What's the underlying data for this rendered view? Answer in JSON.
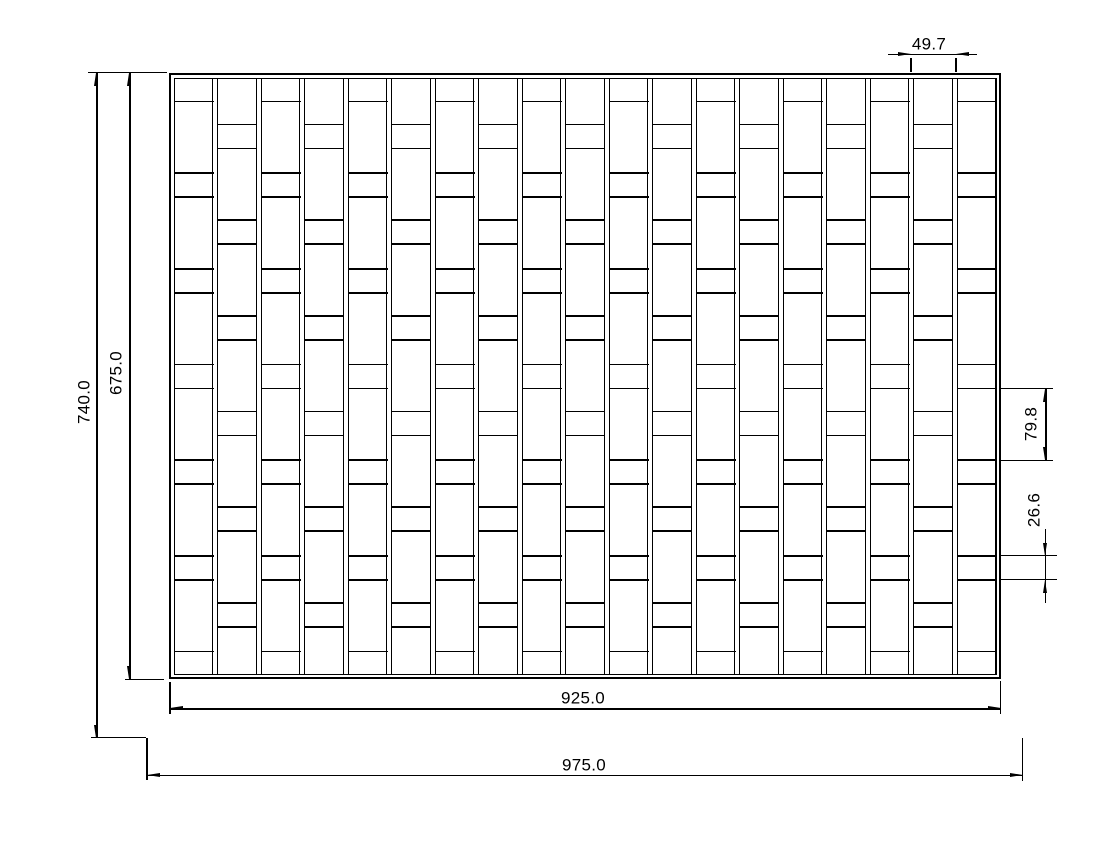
{
  "drawing": {
    "type": "technical-dimension-drawing",
    "background": "#ffffff",
    "line_color": "#000000",
    "panel": {
      "outer": {
        "x": 169,
        "y": 73,
        "w": 832,
        "h": 606
      },
      "border_gap": 4.5,
      "num_slats": 19,
      "slat_width": 40,
      "slat_pitch": 43.5,
      "short_segment": 24,
      "tall_segment": 71.67,
      "odd_column_first_segment": 47
    },
    "dimension_values": {
      "overall_height": "740.0",
      "panel_height": "675.0",
      "panel_width": "925.0",
      "overall_width": "975.0",
      "slat_pitch": "49.7",
      "tall_block_height": "79.8",
      "short_block_height": "26.6"
    },
    "dims": [
      {
        "id": "overall-height",
        "text": "740.0",
        "line": [
          97,
          73,
          97,
          738
        ],
        "arrows": [
          {
            "x": 97,
            "y": 73,
            "dir": "up"
          },
          {
            "x": 97,
            "y": 738,
            "dir": "down"
          }
        ],
        "ext": [
          [
            88,
            72.7,
            167,
            72.7
          ],
          [
            91,
            737.6,
            146,
            737.6
          ]
        ],
        "label": {
          "cx": 84,
          "cy": 402,
          "rot": -90
        }
      },
      {
        "id": "panel-height",
        "text": "675.0",
        "line": [
          130,
          73,
          130,
          679.4
        ],
        "arrows": [
          {
            "x": 130,
            "y": 73,
            "dir": "up"
          },
          {
            "x": 130,
            "y": 679.2,
            "dir": "down"
          }
        ],
        "ext": [
          [
            125,
            679.8,
            164,
            679.8
          ]
        ],
        "label": {
          "cx": 116,
          "cy": 373,
          "rot": -90
        }
      },
      {
        "id": "panel-width",
        "text": "925.0",
        "line": [
          170,
          709,
          1001,
          709
        ],
        "arrows": [
          {
            "x": 170.3,
            "y": 709,
            "dir": "left"
          },
          {
            "x": 1000.7,
            "y": 709,
            "dir": "right"
          }
        ],
        "ext": [
          [
            170,
            682,
            170,
            714
          ],
          [
            1000.7,
            681,
            1000.7,
            713.6
          ]
        ],
        "label": {
          "cx": 583,
          "cy": 698,
          "rot": 0
        }
      },
      {
        "id": "overall-width",
        "text": "975.0",
        "line": [
          147,
          775.5,
          1023,
          775.5
        ],
        "arrows": [
          {
            "x": 147.3,
            "y": 775.5,
            "dir": "left"
          },
          {
            "x": 1022.7,
            "y": 775.5,
            "dir": "right"
          }
        ],
        "ext": [
          [
            147,
            737.6,
            147,
            780.5
          ],
          [
            1022.7,
            738,
            1022.7,
            780.5
          ]
        ],
        "label": {
          "cx": 584,
          "cy": 764.5,
          "rot": 0
        }
      },
      {
        "id": "slat-pitch",
        "text": "49.7",
        "line": [
          888,
          54.3,
          977,
          54.3
        ],
        "arrows": [
          {
            "x": 911,
            "y": 54.3,
            "dir": "right"
          },
          {
            "x": 956,
            "y": 54.3,
            "dir": "left"
          }
        ],
        "ext": [
          [
            911,
            58,
            911,
            71.5
          ],
          [
            956,
            58,
            956,
            71.5
          ]
        ],
        "label": {
          "cx": 929,
          "cy": 44,
          "rot": 0
        }
      },
      {
        "id": "tall-block-height",
        "text": "79.8",
        "line": [
          1046,
          388.5,
          1046,
          460.2
        ],
        "arrows": [
          {
            "x": 1046,
            "y": 388.5,
            "dir": "up"
          },
          {
            "x": 1046,
            "y": 460.2,
            "dir": "down"
          }
        ],
        "ext": [
          [
            999,
            388.5,
            1053,
            388.5
          ],
          [
            999,
            460.2,
            1053,
            460.2
          ]
        ],
        "label": {
          "cx": 1031,
          "cy": 424,
          "rot": -90
        }
      },
      {
        "id": "short-block-height",
        "text": "26.6",
        "line": [
          1045.5,
          529,
          1045.5,
          603
        ],
        "arrows": [
          {
            "x": 1045.5,
            "y": 555.8,
            "dir": "down"
          },
          {
            "x": 1045.5,
            "y": 579.8,
            "dir": "up"
          }
        ],
        "ext": [
          [
            999,
            555.8,
            1057,
            555.8
          ],
          [
            999,
            579.8,
            1057,
            579.8
          ]
        ],
        "label": {
          "cx": 1034,
          "cy": 510,
          "rot": -90
        }
      }
    ]
  }
}
